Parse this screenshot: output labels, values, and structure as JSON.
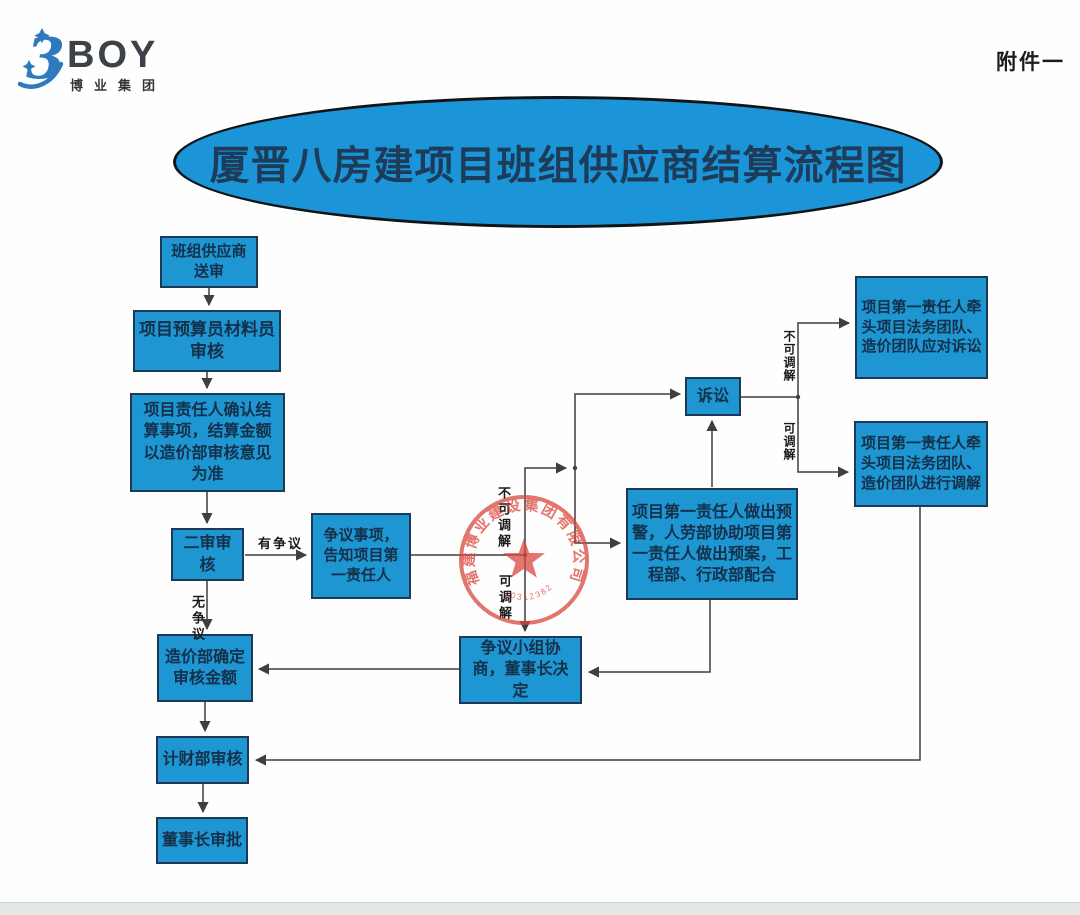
{
  "header": {
    "logo_text": "BOY",
    "logo_subtext": "博业集团",
    "attachment_label": "附件一"
  },
  "title": "厦晋八房建项目班组供应商结算流程图",
  "nodes": {
    "submit": "班组供应商送审",
    "estimator_review": "项目预算员材料员审核",
    "owner_confirm": "项目责任人确认结算事项，结算金额以造价部审核意见为准",
    "second_review": "二审审核",
    "dispute_notify": "争议事项，告知项目第一责任人",
    "cost_dept_confirm": "造价部确定审核金额",
    "finance_review": "计财部审核",
    "chairman_approve": "董事长审批",
    "dispute_group": "争议小组协商，董事长决定",
    "warning_plan": "项目第一责任人做出预警，人劳部协助项目第一责任人做出预案，工程部、行政部配合",
    "litigation": "诉讼",
    "legal_litigation": "项目第一责任人牵头项目法务团队、造价团队应对诉讼",
    "legal_mediation": "项目第一责任人牵头项目法务团队、造价团队进行调解"
  },
  "edge_labels": {
    "disputed": "有争议",
    "undisputed": "无争议",
    "not_mediable_mid": "不可调解",
    "mediable_mid": "可调解",
    "not_mediable_right": "不可调解",
    "mediable_right": "可调解"
  },
  "seal": {
    "company": "福建博业建设集团有限公司",
    "number": "10312382"
  },
  "colors": {
    "node_fill": "#1e96d2",
    "node_border": "#1c3a55",
    "title_fill": "#1b95d8",
    "seal_red": "#d9463c",
    "brand_blue": "#2e7abc",
    "wire": "#3f3f3f"
  }
}
